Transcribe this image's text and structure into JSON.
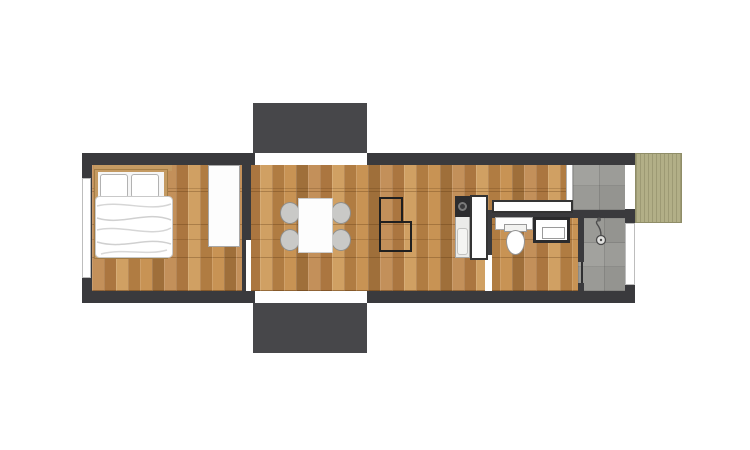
{
  "document_type": "architectural floor plan, top-down view, no text labels",
  "building": {
    "shape": "long horizontal rectangle",
    "walls_color": "#3a3a3d",
    "openings": [
      {
        "name": "top-sliding-door",
        "side": "north",
        "leads_to": "top-porch"
      },
      {
        "name": "bottom-sliding-door",
        "side": "south",
        "leads_to": "bottom-porch"
      },
      {
        "name": "bedroom-window",
        "side": "west"
      },
      {
        "name": "deck-door",
        "side": "east",
        "leads_to": "side-deck"
      },
      {
        "name": "shower-window",
        "side": "east"
      }
    ]
  },
  "rooms": [
    {
      "name": "bedroom",
      "floor": "wood-parquet",
      "position": "left"
    },
    {
      "name": "living-dining",
      "floor": "wood-parquet",
      "position": "center"
    },
    {
      "name": "kitchen-corridor",
      "floor": "wood-parquet",
      "position": "center-right"
    },
    {
      "name": "bathroom",
      "floor": "wood-parquet",
      "position": "right"
    },
    {
      "name": "shower-room",
      "floor": "gray-tile",
      "position": "right"
    },
    {
      "name": "entry-vestibule",
      "floor": "gray-tile",
      "position": "top-right"
    }
  ],
  "outdoor_areas": [
    {
      "name": "top-porch",
      "color": "#47474a"
    },
    {
      "name": "bottom-porch",
      "color": "#47474a"
    },
    {
      "name": "side-deck",
      "color": "#b2af87",
      "texture": "vertical wood boards"
    }
  ],
  "furniture": [
    {
      "name": "double-bed",
      "room": "bedroom",
      "details": "wood frame, two pillows, white duvet"
    },
    {
      "name": "wardrobe",
      "room": "bedroom",
      "details": "white rectangle against north wall"
    },
    {
      "name": "dining-table",
      "room": "living-dining",
      "details": "white rectangle"
    },
    {
      "name": "dining-chairs",
      "room": "living-dining",
      "count": 4,
      "details": "gray round shell chairs"
    },
    {
      "name": "stair-outline",
      "room": "living-dining",
      "details": "L-shaped thin black outline"
    },
    {
      "name": "kitchen-unit",
      "room": "kitchen-corridor",
      "details": "counter column with cooktop and sink"
    },
    {
      "name": "kitchen-wall-counter",
      "room": "kitchen-corridor",
      "details": "white counter along bathroom wall"
    },
    {
      "name": "bathroom-vanity",
      "room": "bathroom",
      "details": "white counter"
    },
    {
      "name": "washbasin-unit",
      "room": "bathroom",
      "details": "dark-framed white box"
    }
  ],
  "fixtures": [
    {
      "name": "toilet",
      "room": "bathroom"
    },
    {
      "name": "shower-head-icon",
      "room": "shower-room"
    }
  ],
  "palette": {
    "wall": "#3a3a3d",
    "porch": "#47474a",
    "wood_floor_base": "#bd8a4f",
    "wood_floor_light": "#d0a063",
    "wood_floor_dark": "#9f6f3a",
    "tile_gray": "#9c9c98",
    "deck_green": "#b2af87",
    "bed_frame": "#c49a62",
    "fixture_white": "#fdfdfd",
    "chair_gray": "#c9c9c7",
    "background": "#ffffff"
  }
}
